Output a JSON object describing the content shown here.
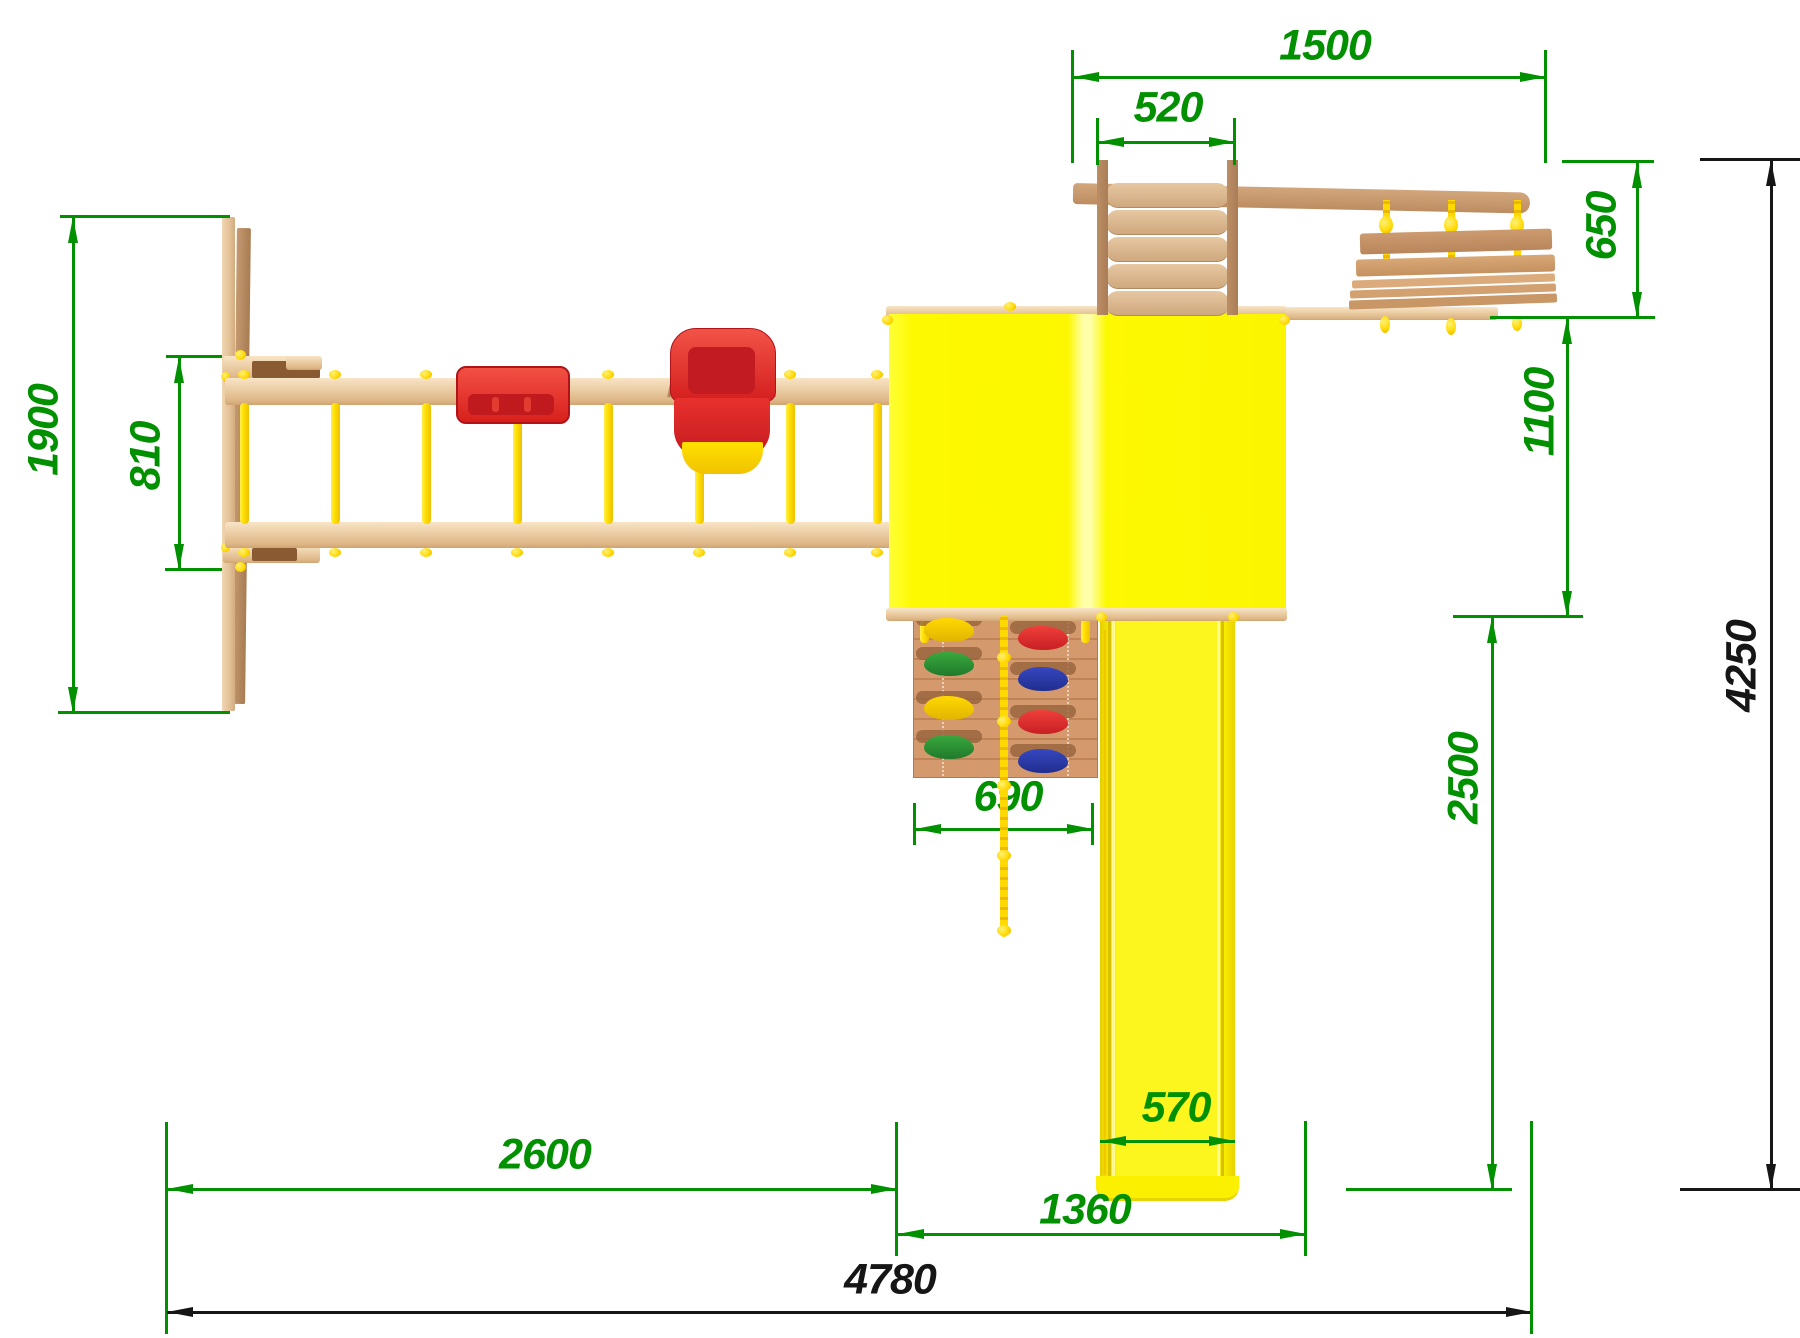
{
  "drawing": {
    "title": "playground-set-top-view-dimensioned-drawing",
    "units": "mm",
    "colors": {
      "dimension_green": "#009000",
      "dimension_black": "#161616",
      "structure_yellow": "#fcf800",
      "rope_yellow": "#ffd900",
      "wood_light": "#eccfa6",
      "wood_dark": "#bd8d61",
      "seat_red": "#e63228",
      "hold_green": "#2e9e44",
      "hold_blue": "#2b3fae",
      "hold_red": "#e03038",
      "hold_yellow": "#f0d000"
    },
    "dims": {
      "d1500": {
        "value": "1500",
        "orientation": "horizontal",
        "color": "green"
      },
      "d520": {
        "value": "520",
        "orientation": "horizontal",
        "color": "green"
      },
      "d650": {
        "value": "650",
        "orientation": "vertical",
        "color": "green"
      },
      "d1100": {
        "value": "1100",
        "orientation": "vertical",
        "color": "green"
      },
      "d4250": {
        "value": "4250",
        "orientation": "vertical",
        "color": "black"
      },
      "d1900": {
        "value": "1900",
        "orientation": "vertical",
        "color": "green"
      },
      "d810": {
        "value": "810",
        "orientation": "vertical",
        "color": "green"
      },
      "d690": {
        "value": "690",
        "orientation": "horizontal",
        "color": "green"
      },
      "d2500": {
        "value": "2500",
        "orientation": "vertical",
        "color": "green"
      },
      "d570": {
        "value": "570",
        "orientation": "horizontal",
        "color": "green"
      },
      "d2600": {
        "value": "2600",
        "orientation": "horizontal",
        "color": "green"
      },
      "d1360": {
        "value": "1360",
        "orientation": "horizontal",
        "color": "green"
      },
      "d4780": {
        "value": "4780",
        "orientation": "horizontal",
        "color": "black"
      }
    },
    "parts": [
      "a-frame-plank",
      "monkey-bar-beam-top",
      "monkey-bar-beam-bottom",
      "monkey-bar-rungs",
      "flat-swing-seat",
      "baby-swing-seat",
      "tower-roof",
      "wooden-ladder",
      "top-beam",
      "rope-bench-swing",
      "climbing-wall",
      "climbing-rope",
      "slide"
    ]
  }
}
